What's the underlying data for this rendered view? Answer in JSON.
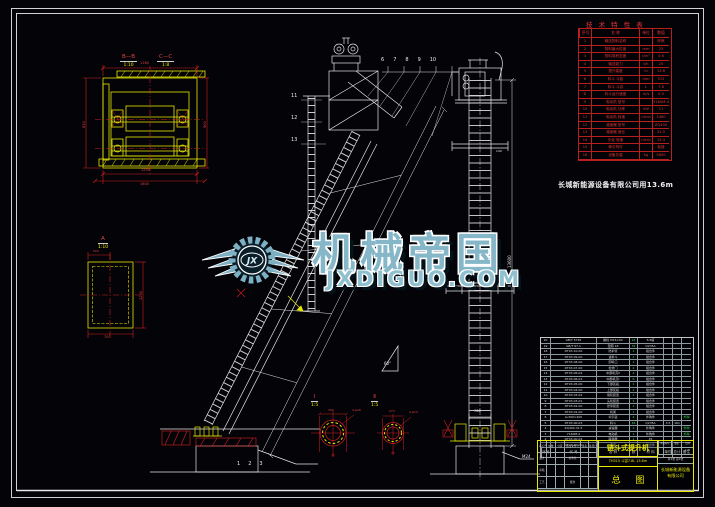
{
  "watermark": {
    "brand": "机械帝国",
    "domain": "JXDIGUO.COM",
    "logo_text": "JX",
    "color": "#7db0c2"
  },
  "note": "长城新能源设备有限公司用13.6m",
  "tech_table": {
    "title": "技 术 特 性 表",
    "headers": [
      "序号",
      "名  称",
      "单位",
      "数值"
    ],
    "rows": [
      {
        "n": "1",
        "name": "输送物料名称",
        "u": "",
        "v": "碎焦"
      },
      {
        "n": "2",
        "name": "物料最大粒度",
        "u": "mm",
        "v": "25"
      },
      {
        "n": "3",
        "name": "物料堆积密度",
        "u": "t/m³",
        "v": "0.6"
      },
      {
        "n": "4",
        "name": "输送能力",
        "u": "t/h",
        "v": "25"
      },
      {
        "n": "5",
        "name": "提升高度",
        "u": "m",
        "v": "13.6"
      },
      {
        "n": "6",
        "name": "料斗 斗距",
        "u": "mm",
        "v": "512"
      },
      {
        "n": "7",
        "name": "料斗 斗容",
        "u": "L",
        "v": "7.8"
      },
      {
        "n": "8",
        "name": "料斗运行速度",
        "u": "m/s",
        "v": "0.5"
      },
      {
        "n": "9",
        "name": "电动机 型号",
        "u": "",
        "v": "Y160M-4"
      },
      {
        "n": "10",
        "name": "电动机 功率",
        "u": "kW",
        "v": "11"
      },
      {
        "n": "11",
        "name": "电动机 转速",
        "u": "r/min",
        "v": "1460"
      },
      {
        "n": "12",
        "name": "减速器 型号",
        "u": "",
        "v": "ZQ400"
      },
      {
        "n": "13",
        "name": "减速器 速比",
        "u": "",
        "v": "31.5"
      },
      {
        "n": "14",
        "name": "头轮 转速",
        "u": "r/min",
        "v": "15.4"
      },
      {
        "n": "15",
        "name": "牵引构件",
        "u": "",
        "v": "板链"
      },
      {
        "n": "16",
        "name": "设备总重",
        "u": "kg",
        "v": "5800"
      }
    ]
  },
  "bom": {
    "headers": [
      "序号",
      "代  号",
      "名  称",
      "数量",
      "材  料",
      "单件",
      "总计",
      "备注"
    ],
    "rows": [
      {
        "n": "20",
        "c": "GB/T 5782",
        "m": "螺栓 M16×60",
        "q": "16",
        "mat": "8.8级",
        "w1": "",
        "w2": "",
        "r": ""
      },
      {
        "n": "19",
        "c": "GB/T 97.1",
        "m": "垫圈 16",
        "q": "32",
        "mat": "Q235A",
        "w1": "",
        "w2": "",
        "r": ""
      },
      {
        "n": "18",
        "c": "DT03-10-00",
        "m": "防护罩",
        "q": "1",
        "mat": "组合件",
        "w1": "",
        "w2": "",
        "r": ""
      },
      {
        "n": "17",
        "c": "DT03-09-00",
        "m": "进料斗",
        "q": "1",
        "mat": "组合件",
        "w1": "",
        "w2": "",
        "r": ""
      },
      {
        "n": "16",
        "c": "DT03-08-00",
        "m": "卸料口",
        "q": "1",
        "mat": "组合件",
        "w1": "",
        "w2": "",
        "r": ""
      },
      {
        "n": "15",
        "c": "DT03-07-00",
        "m": "检修门",
        "q": "2",
        "mat": "组合件",
        "w1": "",
        "w2": "",
        "r": ""
      },
      {
        "n": "14",
        "c": "DT03-06-02",
        "m": "中部机壳Ⅱ",
        "q": "4",
        "mat": "组合件",
        "w1": "",
        "w2": "",
        "r": ""
      },
      {
        "n": "13",
        "c": "DT03-06-01",
        "m": "中部机壳Ⅰ",
        "q": "6",
        "mat": "组合件",
        "w1": "",
        "w2": "",
        "r": ""
      },
      {
        "n": "12",
        "c": "DT03-05-00",
        "m": "下部区段",
        "q": "1",
        "mat": "组合件",
        "w1": "",
        "w2": "",
        "r": ""
      },
      {
        "n": "11",
        "c": "DT03-04-00",
        "m": "上部区段",
        "q": "1",
        "mat": "组合件",
        "w1": "",
        "w2": "",
        "r": ""
      },
      {
        "n": "10",
        "c": "DT03-03-02",
        "m": "尾轮装置",
        "q": "1",
        "mat": "组合件",
        "w1": "",
        "w2": "",
        "r": ""
      },
      {
        "n": "9",
        "c": "DT03-03-01",
        "m": "头轮装置",
        "q": "1",
        "mat": "组合件",
        "w1": "",
        "w2": "",
        "r": ""
      },
      {
        "n": "8",
        "c": "DT03-02-00",
        "m": "张紧装置",
        "q": "1",
        "mat": "组合件",
        "w1": "",
        "w2": "",
        "r": ""
      },
      {
        "n": "7",
        "c": "DT03-01-00",
        "m": "机架",
        "q": "1",
        "mat": "组合件",
        "w1": "",
        "w2": "",
        "r": ""
      },
      {
        "n": "6",
        "c": "LL300×400",
        "m": "牵引链",
        "q": "2",
        "mat": "外购件",
        "w1": "",
        "w2": "",
        "r": "外购"
      },
      {
        "n": "5",
        "c": "DT03-00-03",
        "m": "料斗",
        "q": "46",
        "mat": "Q235A",
        "w1": "3.5",
        "w2": "161",
        "r": ""
      },
      {
        "n": "4",
        "c": "ZQ400-31.5",
        "m": "减速器",
        "q": "1",
        "mat": "外购件",
        "w1": "",
        "w2": "",
        "r": "外购"
      },
      {
        "n": "3",
        "c": "Y160M-4",
        "m": "电动机",
        "q": "1",
        "mat": "外购件",
        "w1": "",
        "w2": "",
        "r": "外购"
      },
      {
        "n": "2",
        "c": "DT03-00-02",
        "m": "联轴器",
        "q": "1",
        "mat": "45",
        "w1": "",
        "w2": "",
        "r": ""
      },
      {
        "n": "1",
        "c": "DT03-00-01",
        "m": "底座",
        "q": "1",
        "mat": "组合件",
        "w1": "",
        "w2": "",
        "r": ""
      }
    ]
  },
  "titleblock": {
    "title": "链斗式提升机",
    "model": "TH315   斗容7.8L   13.6m",
    "drawing_name": "总 图",
    "rev_cells": [
      "标记",
      "处数",
      "分区",
      "更改文件号",
      "签名",
      "年月日",
      "设计",
      "",
      "",
      "标准化",
      "",
      "",
      "审核",
      "",
      "",
      "",
      "",
      "",
      "工艺",
      "",
      "",
      "批准",
      "",
      ""
    ],
    "stage_labels": [
      "阶段标记",
      "重量",
      "比例"
    ],
    "stage_values": [
      "",
      "",
      "1:25"
    ],
    "sheet": "共1张 第1张",
    "company": "长城新能源设备有限公司"
  },
  "views": {
    "bb": "B—B",
    "bb_scale": "1:10",
    "cc": "C—C",
    "cc_scale": "1:8",
    "a": "A",
    "a_scale": "1:10",
    "d1": "Ⅰ",
    "d1_scale": "1:5",
    "d2": "Ⅱ",
    "d2_scale": "1:5"
  },
  "dims": {
    "head_top": "1160",
    "head_left": "830",
    "head_right": "900",
    "head_bottom": "1250",
    "head_bottom2": "1600",
    "a_top": "500",
    "a_right": "1200",
    "a_bottom": "700",
    "d1_width": "356",
    "d1_holes": "4-φ18",
    "d2_width": "273",
    "d2_holes": "4-φ14",
    "col_height": "13600",
    "col_base": "780",
    "col_anchor": "M24",
    "col_flange": "140",
    "incline_len": "10500",
    "incline_angle": "60°"
  },
  "callouts": {
    "top": [
      "6",
      "7",
      "8",
      "9",
      "10"
    ],
    "left": [
      "11",
      "12",
      "13"
    ],
    "bottom": [
      "1",
      "2",
      "3"
    ]
  }
}
